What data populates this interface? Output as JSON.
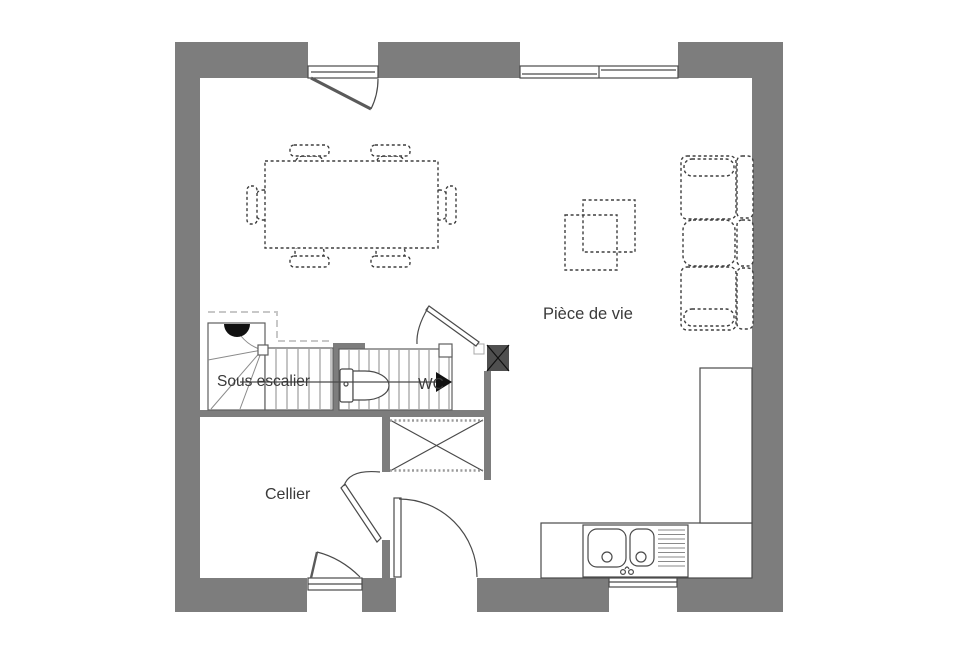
{
  "plan": {
    "type": "architectural-floor-plan",
    "floor": "ground-floor",
    "labels": {
      "living_room": "Pièce de vie",
      "under_stairs": "Sous escalier",
      "cellar": "Cellier",
      "wc": "WC"
    },
    "rooms": [
      {
        "name": "Pièce de vie"
      },
      {
        "name": "Cellier"
      },
      {
        "name": "WC"
      },
      {
        "name": "Sous escalier"
      }
    ],
    "features": [
      "front-door",
      "sliding-window",
      "entrance-door",
      "cellar-door",
      "wc-door",
      "cellar-window",
      "kitchen-window",
      "stairs-with-winder",
      "toilet",
      "technical-duct",
      "sliding-closet",
      "kitchen-counter",
      "kitchen-sink",
      "tall-cabinet",
      "sofa-3-seats",
      "coffee-tables",
      "dining-table-6-chairs"
    ],
    "colors": {
      "wall": "#7d7d7d",
      "duct": "#4f4f4f",
      "outline": "#4a4a4a",
      "furniture": "#3f3f3f",
      "tread": "#8a8a8a",
      "guide": "#c8c8c8",
      "text": "#3a3a3a",
      "background": "#ffffff",
      "accent_black": "#111111"
    }
  }
}
